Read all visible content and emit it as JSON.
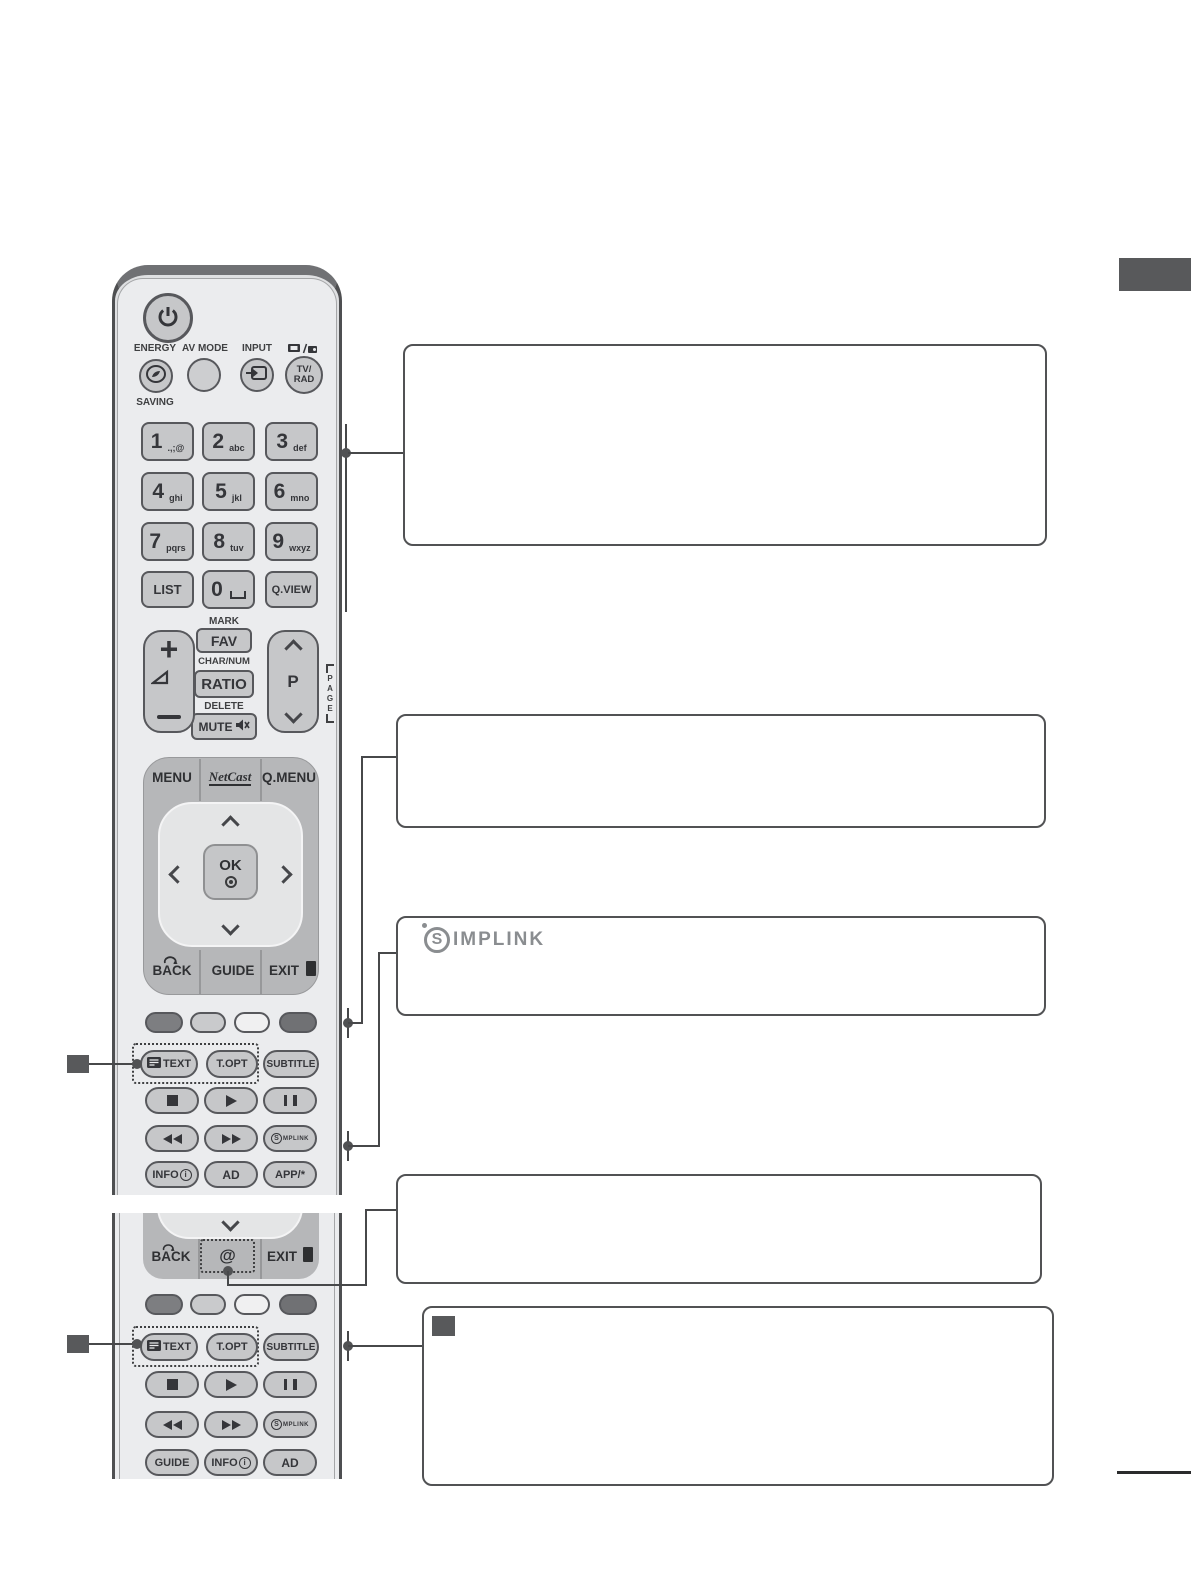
{
  "remote": {
    "labels": {
      "energy": "ENERGY",
      "saving": "SAVING",
      "av_mode": "AV MODE",
      "input": "INPUT"
    },
    "tv_rad": {
      "l1": "TV/",
      "l2": "RAD"
    },
    "keys": [
      {
        "n": "1",
        "s": ".,;@"
      },
      {
        "n": "2",
        "s": "abc"
      },
      {
        "n": "3",
        "s": "def"
      },
      {
        "n": "4",
        "s": "ghi"
      },
      {
        "n": "5",
        "s": "jkl"
      },
      {
        "n": "6",
        "s": "mno"
      },
      {
        "n": "7",
        "s": "pqrs"
      },
      {
        "n": "8",
        "s": "tuv"
      },
      {
        "n": "9",
        "s": "wxyz"
      }
    ],
    "list": "LIST",
    "zero": "0",
    "qview": "Q.VIEW",
    "mark": "MARK",
    "fav": "FAV",
    "charnum": "CHAR/NUM",
    "ratio": "RATIO",
    "delete": "DELETE",
    "mute": "MUTE",
    "vol_plus": "+",
    "p": "P",
    "page": [
      "P",
      "A",
      "G",
      "E"
    ],
    "menu": "MENU",
    "netcast": "NetCast",
    "qmenu": "Q.MENU",
    "ok": "OK",
    "back": "BACK",
    "guide": "GUIDE",
    "exit": "EXIT",
    "text": "TEXT",
    "topt": "T.OPT",
    "subtitle": "SUBTITLE",
    "info": "INFO",
    "info_i": "i",
    "ad": "AD",
    "app": "APP/*",
    "simplink_s": "S",
    "simplink_rest": "MPLINK",
    "at": "@"
  },
  "remote2": {
    "back": "BACK",
    "at": "@",
    "exit": "EXIT",
    "text": "TEXT",
    "topt": "T.OPT",
    "subtitle": "SUBTITLE",
    "guide": "GUIDE",
    "info": "INFO",
    "info_i": "i",
    "ad": "AD",
    "simplink_s": "S",
    "simplink_rest": "MPLINK"
  },
  "simplink_box": {
    "s": "S",
    "rest": "IMPLINK"
  },
  "colors": {
    "marker": "#58595b",
    "connector": "#47484a",
    "box_border": "#515254",
    "tab": "#58595b"
  }
}
